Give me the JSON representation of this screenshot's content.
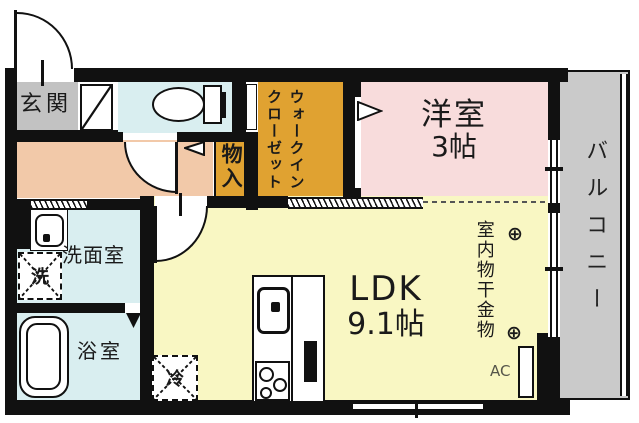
{
  "rooms": {
    "genkan": {
      "label": "玄関"
    },
    "wic": {
      "lines": [
        "ウォークイン",
        "クローゼット"
      ]
    },
    "bedroom": {
      "name": "洋室",
      "size": "3帖"
    },
    "monoiri": {
      "label": "物入"
    },
    "washroom": {
      "label": "洗面室"
    },
    "bathroom": {
      "label": "浴室"
    },
    "ldk": {
      "name": "LDK",
      "size": "9.1帖"
    },
    "balcony": {
      "label": "バルコニー"
    }
  },
  "annotations": {
    "laundry_hardware": "室内物干金物",
    "hook_symbol": "⊕",
    "ac": "AC",
    "washer": "洗",
    "fridge": "冷"
  },
  "colors": {
    "wall": "#111111",
    "genkan_floor": "#c2c2c2",
    "wet_floor": "#d9eef0",
    "hallway_floor": "#f2c9a9",
    "closet_floor": "#e0a231",
    "bedroom_floor": "#f8dcdc",
    "ldk_floor": "#f9f7c3",
    "balcony_floor": "#cacaca"
  }
}
